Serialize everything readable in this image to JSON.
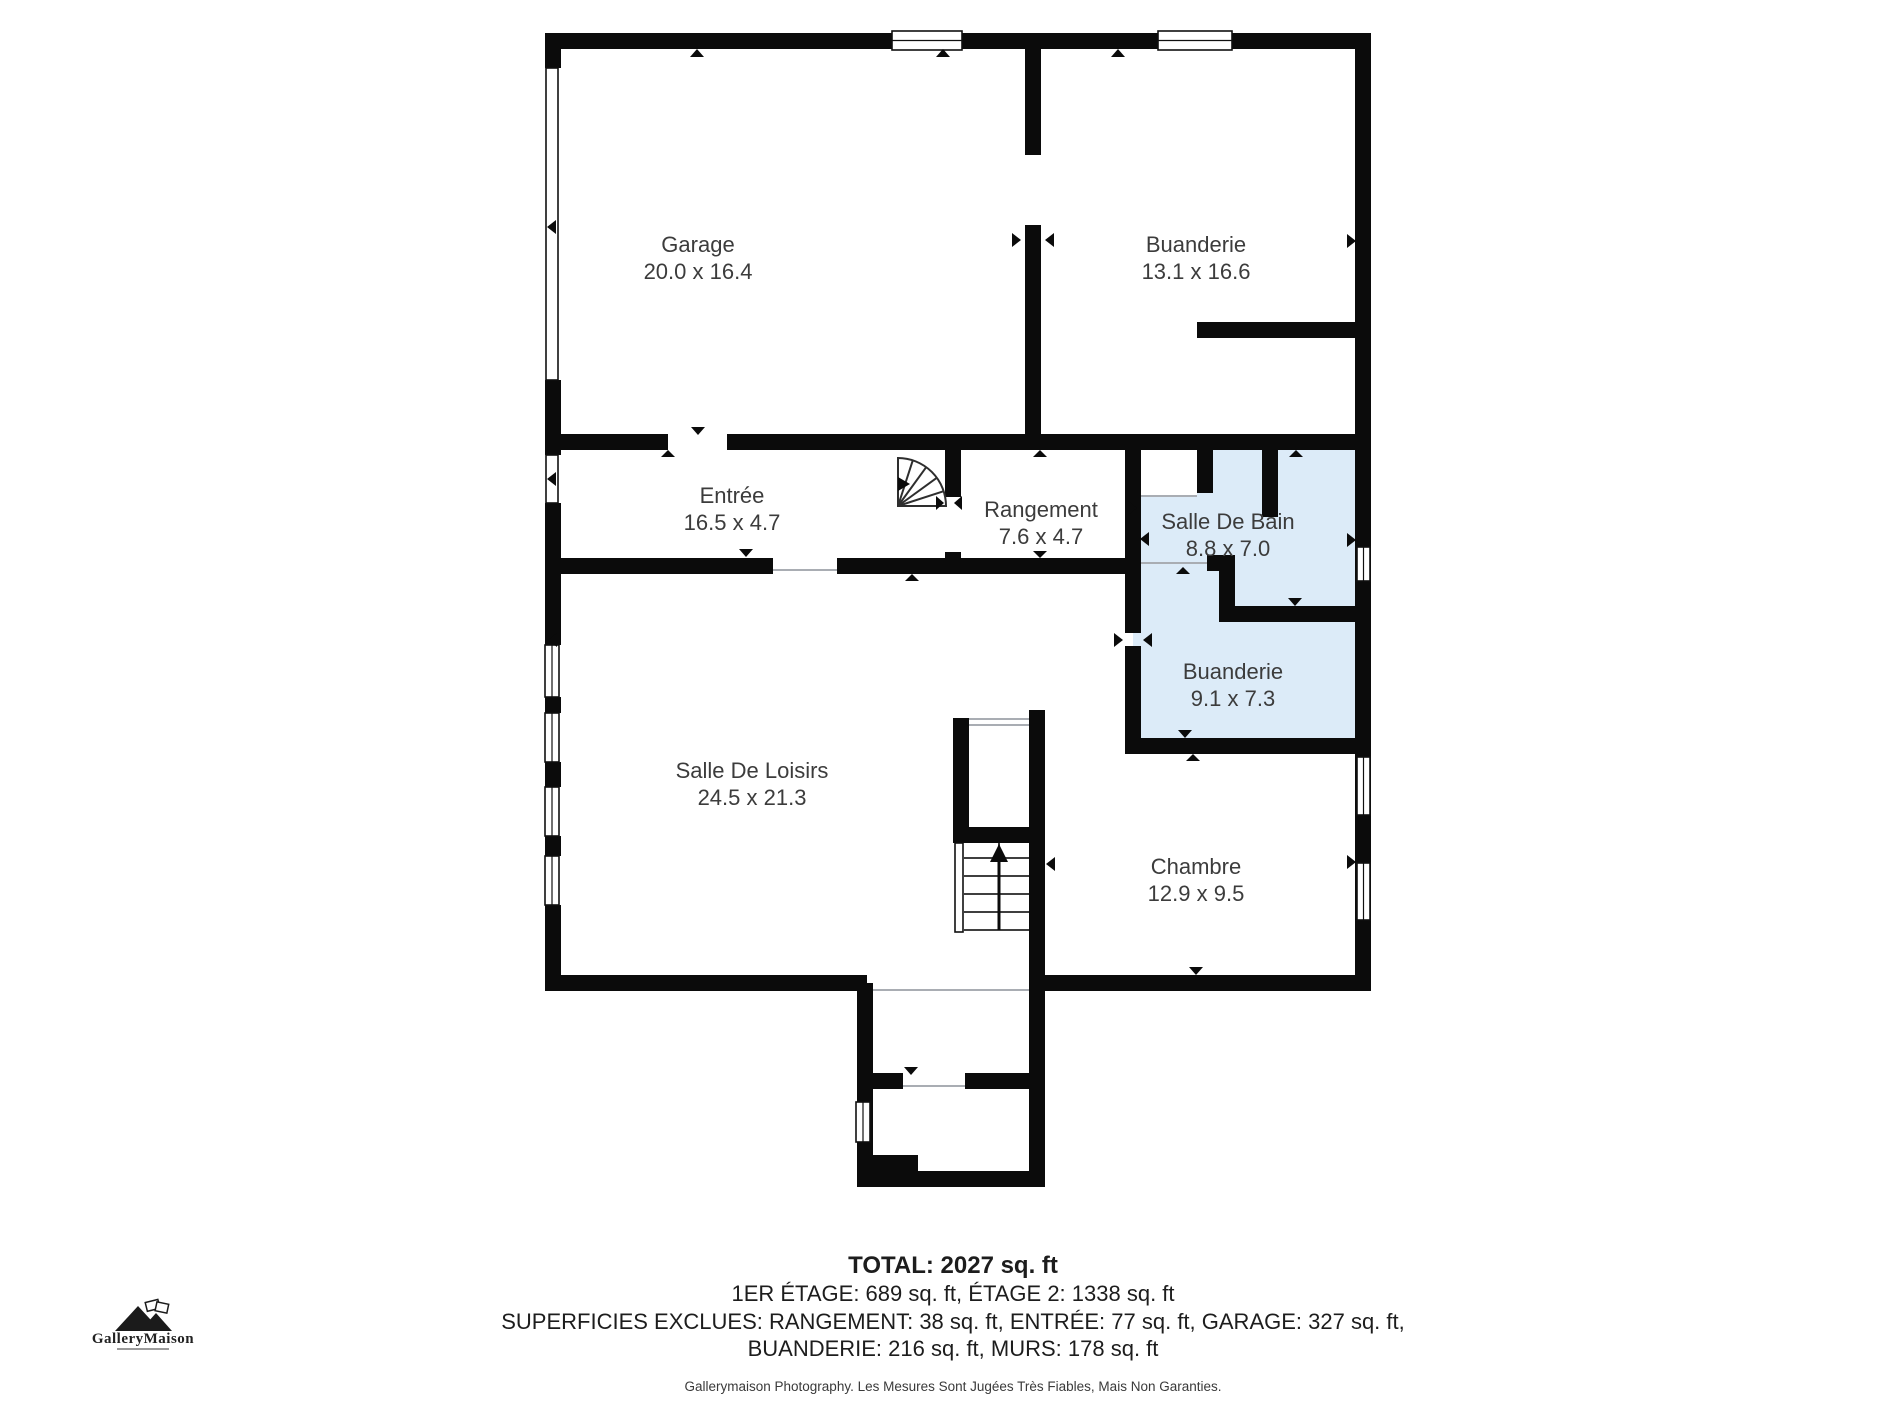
{
  "rooms": {
    "garage": {
      "name": "Garage",
      "dims": "20.0 x 16.4"
    },
    "buanderie_haut": {
      "name": "Buanderie",
      "dims": "13.1 x 16.6"
    },
    "entree": {
      "name": "Entrée",
      "dims": "16.5 x 4.7"
    },
    "rangement": {
      "name": "Rangement",
      "dims": "7.6 x 4.7"
    },
    "salle_de_bain": {
      "name": "Salle De Bain",
      "dims": "8.8 x 7.0"
    },
    "buanderie_bas": {
      "name": "Buanderie",
      "dims": "9.1 x 7.3"
    },
    "salle_de_loisirs": {
      "name": "Salle De Loisirs",
      "dims": "24.5 x 21.3"
    },
    "chambre": {
      "name": "Chambre",
      "dims": "12.9 x 9.5"
    }
  },
  "footer": {
    "total": "TOTAL: 2027 sq. ft",
    "line2": "1ER ÉTAGE: 689 sq. ft, ÉTAGE 2: 1338 sq. ft",
    "line3": "SUPERFICIES EXCLUES: RANGEMENT: 38 sq. ft, ENTRÉE: 77 sq. ft, GARAGE: 327 sq. ft,",
    "line4": "BUANDERIE: 216 sq. ft, MURS: 178 sq. ft",
    "disclaimer": "Gallerymaison Photography. Les Mesures Sont Jugées Très Fiables, Mais Non Garanties."
  },
  "logo": {
    "brand": "GalleryMaison"
  },
  "colors": {
    "wall": "#0b0b0b",
    "room_fill": "#ffffff",
    "highlight_fill": "#dcebf8",
    "label": "#3c3c3c",
    "footer_text": "#1d1d1d",
    "marker": "#0b0b0b"
  }
}
